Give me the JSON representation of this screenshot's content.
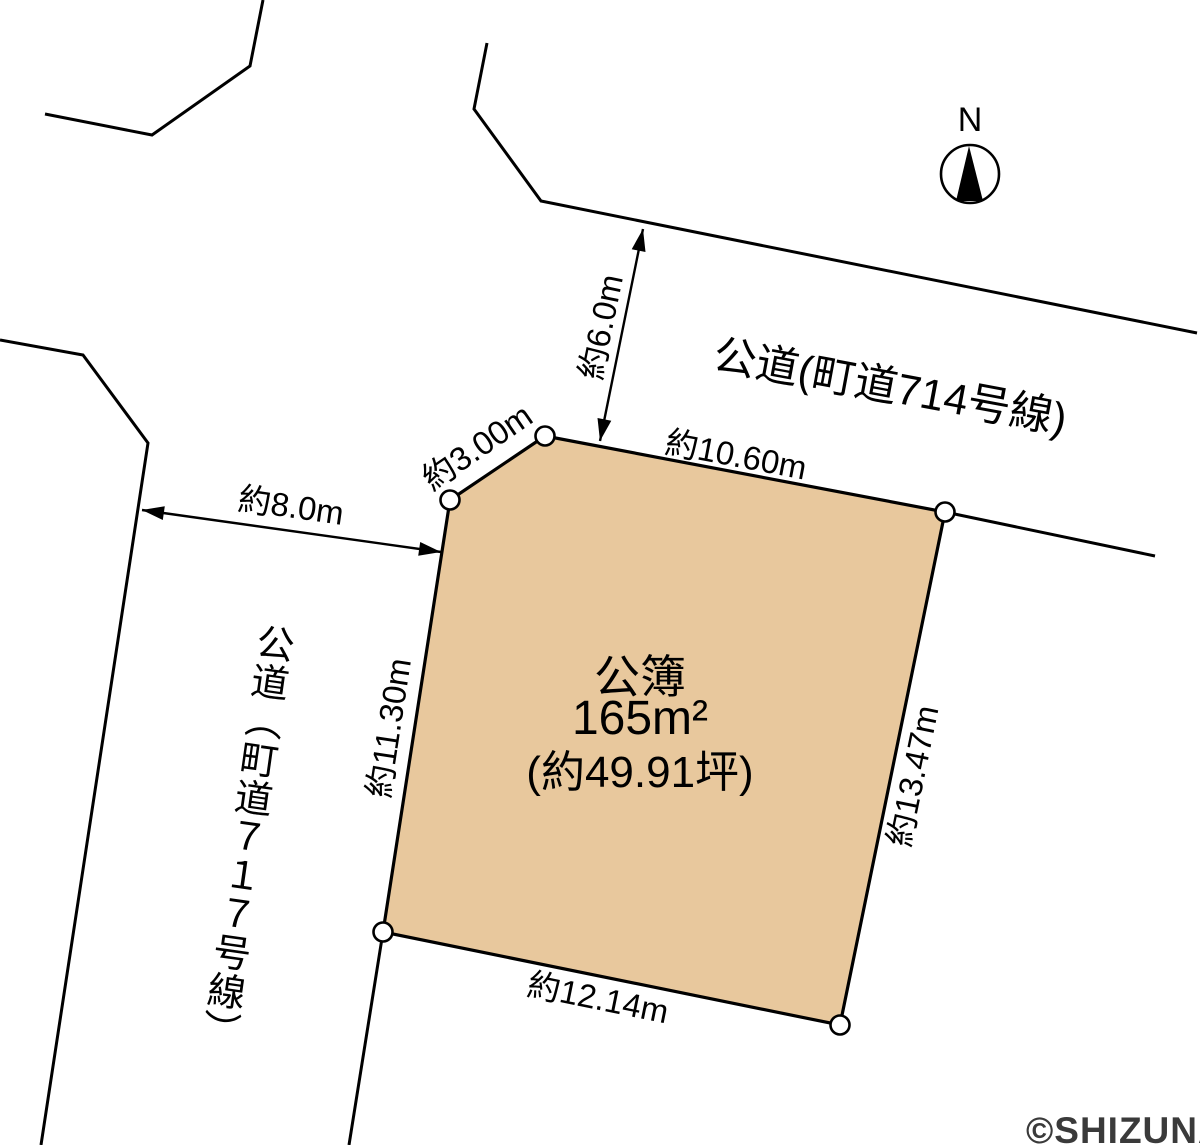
{
  "diagram": {
    "compass": {
      "label": "N"
    },
    "roads": {
      "road714": {
        "label": "公道(町道714号線)"
      },
      "road717": {
        "label": "公道（町道７１７号線）"
      }
    },
    "parcel": {
      "register": "公簿",
      "area_m2": "165m²",
      "area_tsubo": "(約49.91坪)"
    },
    "dimensions": {
      "corner_cut": "約3.00m",
      "top_edge": "約10.60m",
      "left_edge": "約11.30m",
      "right_edge": "約13.47m",
      "bottom_edge": "約12.14m",
      "road717_width": "約8.0m",
      "road714_width": "約6.0m"
    },
    "watermark": {
      "text": "©SHIZUNAVI"
    },
    "colors": {
      "parcel_fill": "#e8c89d",
      "line": "#000000",
      "watermark": "#3a3a3a"
    }
  }
}
